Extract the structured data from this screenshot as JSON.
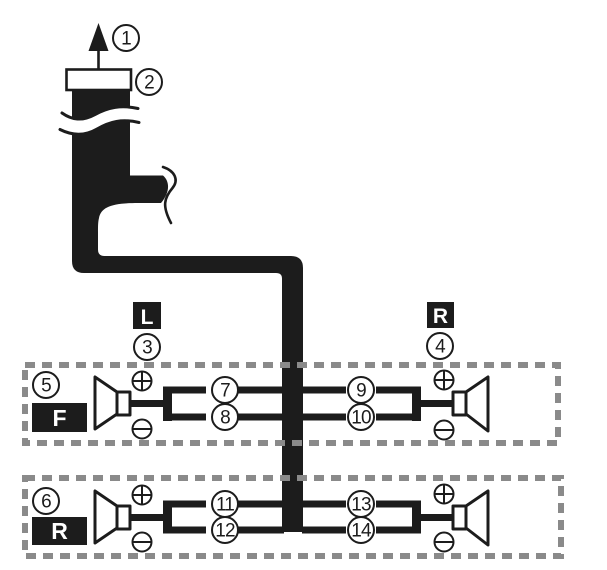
{
  "callouts": [
    "1",
    "2",
    "3",
    "4",
    "5",
    "6",
    "7",
    "8",
    "9",
    "10",
    "11",
    "12",
    "13",
    "14"
  ],
  "channel_labels": {
    "left": "L",
    "right": "R"
  },
  "row_labels": {
    "front": "F",
    "rear": "R"
  },
  "symbols": {
    "plus": "+",
    "minus": "-"
  },
  "colors": {
    "ink": "#1c1c1c",
    "dash_gray": "#8a8a8a",
    "background": "#ffffff"
  }
}
